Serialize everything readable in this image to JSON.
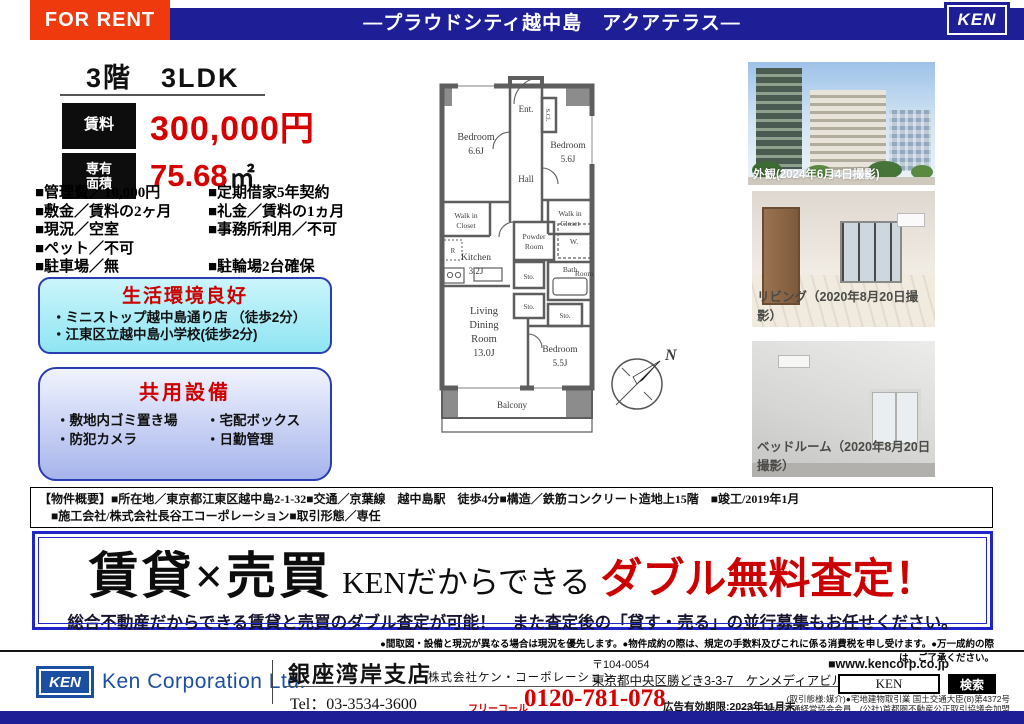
{
  "header": {
    "for_rent": "FOR RENT",
    "title": "―プラウドシティ越中島　アクアテラス―",
    "logo_text": "KEN"
  },
  "summary": {
    "headline": "3階　3LDK",
    "rent_label": "賃料",
    "rent_value": "300,000円",
    "area_label_1": "専有",
    "area_label_2": "面積",
    "area_value": "75.68",
    "area_unit": "㎡",
    "details_left": [
      "■管理費／10,000円",
      "■敷金／賃料の2ヶ月",
      "■現況／空室",
      "■ペット／不可",
      "■駐車場／無"
    ],
    "details_right": [
      "■定期借家5年契約",
      "■礼金／賃料の1ヵ月",
      "■事務所利用／不可",
      "",
      "■駐輪場2台確保"
    ]
  },
  "environment_box": {
    "title": "生活環境良好",
    "items": [
      "・ミニストップ越中島通り店 （徒歩2分）",
      "・江東区立越中島小学校(徒歩2分)"
    ]
  },
  "facilities_box": {
    "title": "共用設備",
    "items_left": [
      "・敷地内ゴミ置き場",
      "・防犯カメラ"
    ],
    "items_right": [
      "・宅配ボックス",
      "・日勤管理"
    ]
  },
  "floorplan": {
    "bedroom1_name": "Bedroom",
    "bedroom1_size": "6.6J",
    "bedroom2_name": "Bedroom",
    "bedroom2_size": "5.6J",
    "bedroom3_name": "Bedroom",
    "bedroom3_size": "5.5J",
    "living_1": "Living",
    "living_2": "Dining",
    "living_3": "Room",
    "living_size": "13.0J",
    "kitchen_name": "Kitchen",
    "kitchen_size": "3.2J",
    "ent": "Ent.",
    "scl": "S.Cl.",
    "hall": "Hall",
    "wic_left_1": "Walk in",
    "wic_left_2": "Closet",
    "wic_right_1": "Walk in",
    "wic_right_2": "Closet",
    "powder_1": "Powder",
    "powder_2": "Room",
    "w_label": "W.",
    "r_label": "R",
    "bath_1": "Bath",
    "bath_2": "Room",
    "sto_1": "Sto.",
    "sto_2": "Sto.",
    "sto_3": "Sto.",
    "balcony": "Balcony",
    "compass_n": "N"
  },
  "photos": {
    "exterior_caption": "外観(2024年6月4日撮影)",
    "living_caption": "リビング（2020年8月20日撮影）",
    "bedroom_caption": "ベッドルーム（2020年8月20日撮影）"
  },
  "property_overview": {
    "label": "【物件概要】",
    "line1": "■所在地／東京都江東区越中島2-1-32■交通／京葉線　越中島駅　徒歩4分■構造／鉄筋コンクリート造地上15階　■竣工/2019年1月",
    "line2": "■施工会社/株式会社長谷工コーポレーション■取引形態／専任"
  },
  "banner": {
    "headline_left": "賃貸×売買",
    "headline_mid": "KENだからできる",
    "headline_right": "ダブル無料査定！",
    "subline": "総合不動産だからできる賃貸と売買のダブル査定が可能！　また査定後の「貸す・売る」の並行募集もお任せください。"
  },
  "disclaimer": "●間取図・設備と現況が異なる場合は現況を優先します。●物件成約の際は、規定の手数料及びこれに係る消費税を申し受けます。●万一成約の際は、ご了承ください。",
  "footer": {
    "logo_text": "KEN",
    "company_en": "Ken Corporation Ltd.",
    "branch": "銀座湾岸支店",
    "company_jp": "株式会社ケン・コーポレーション",
    "postal": "〒104-0054",
    "address": "東京都中央区勝どき3-3-7　ケンメディアビル７階",
    "tel": "Tel：03-3534-3600",
    "freecall_label": "フリーコール",
    "freecall_number": "0120-781-078",
    "ad_validity": "広告有効期限:2023年11月末",
    "website": "■www.kencorp.co.jp",
    "search_value": "KEN",
    "search_button": "検索",
    "license_line1": "(取引態様:媒介)●宅地建物取引業 国土交通大臣(8)第4372号",
    "license_line2": "(一社)不動産流通経営協会会員　(公社)首都圏不動産公正取引協議会加盟"
  },
  "colors": {
    "navy": "#1e1e96",
    "orange_red": "#ee3a0c",
    "price_red": "#d60000",
    "ken_blue": "#1d4fa0"
  }
}
